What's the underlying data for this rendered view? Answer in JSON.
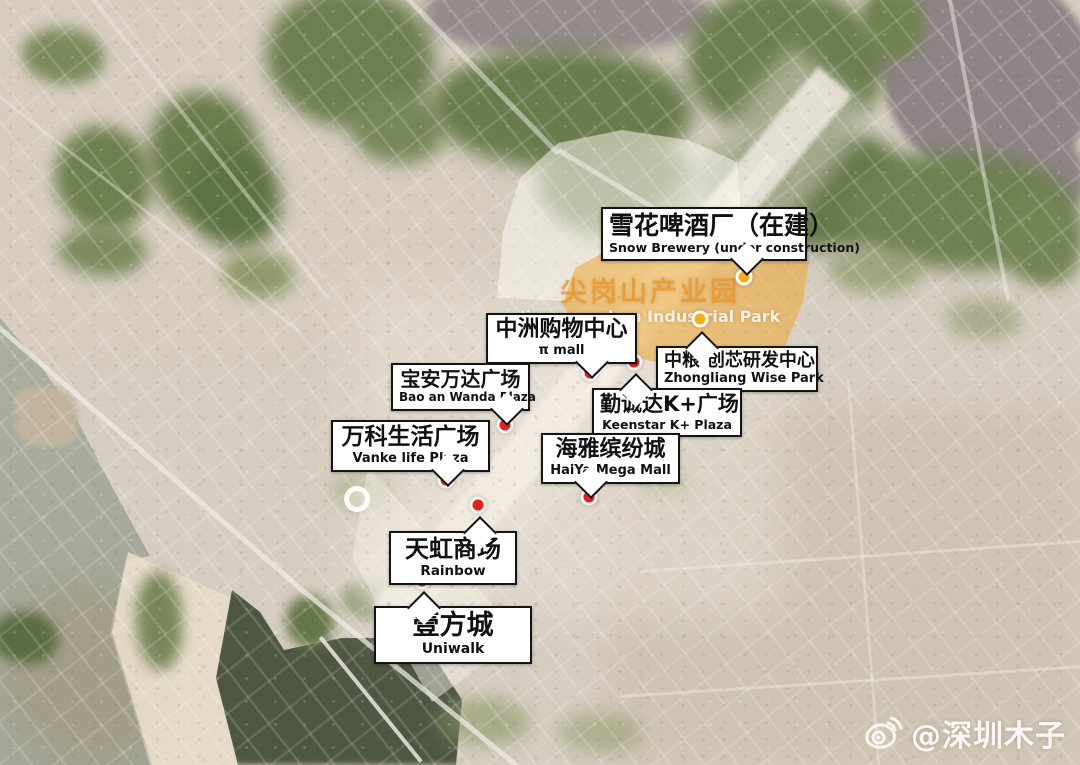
{
  "area_label": {
    "cn": "尖岗山产业园",
    "en": "Jiangangshan Industrial Park"
  },
  "markers": [
    {
      "id": "snow-brewery",
      "cn": "雪花啤酒厂（在建）",
      "en": "Snow Brewery (under construction)",
      "dot": "yellow"
    },
    {
      "id": "pi-mall",
      "cn": "中洲购物中心",
      "en": "π mall",
      "dot": "red"
    },
    {
      "id": "zhongliang-wise-park",
      "cn": "中粮·创芯研发中心",
      "en": "Zhongliang Wise Park",
      "dot": "yellow"
    },
    {
      "id": "keenstar-k-plaza",
      "cn": "勤诚达K+广场",
      "en": "Keenstar K+ Plaza",
      "dot": "red"
    },
    {
      "id": "baoan-wanda-plaza",
      "cn": "宝安万达广场",
      "en": "Bao an Wanda Plaza",
      "dot": "red"
    },
    {
      "id": "vanke-life-plaza",
      "cn": "万科生活广场",
      "en": "Vanke life Plaza",
      "dot": "red"
    },
    {
      "id": "haiya-mega-mall",
      "cn": "海雅缤纷城",
      "en": "HaiYa Mega Mall",
      "dot": "red"
    },
    {
      "id": "rainbow",
      "cn": "天虹商场",
      "en": "Rainbow",
      "dot": "red"
    },
    {
      "id": "uniwalk",
      "cn": "壹方城",
      "en": "Uniwalk",
      "dot": "red"
    }
  ],
  "watermark": {
    "text": "@深圳木子",
    "icon": "weibo-icon"
  },
  "colors": {
    "red_dot": "#e5201c",
    "yellow_dot": "#f2ae17",
    "park_overlay": "#eca32a",
    "park_text": "#e8942c"
  }
}
